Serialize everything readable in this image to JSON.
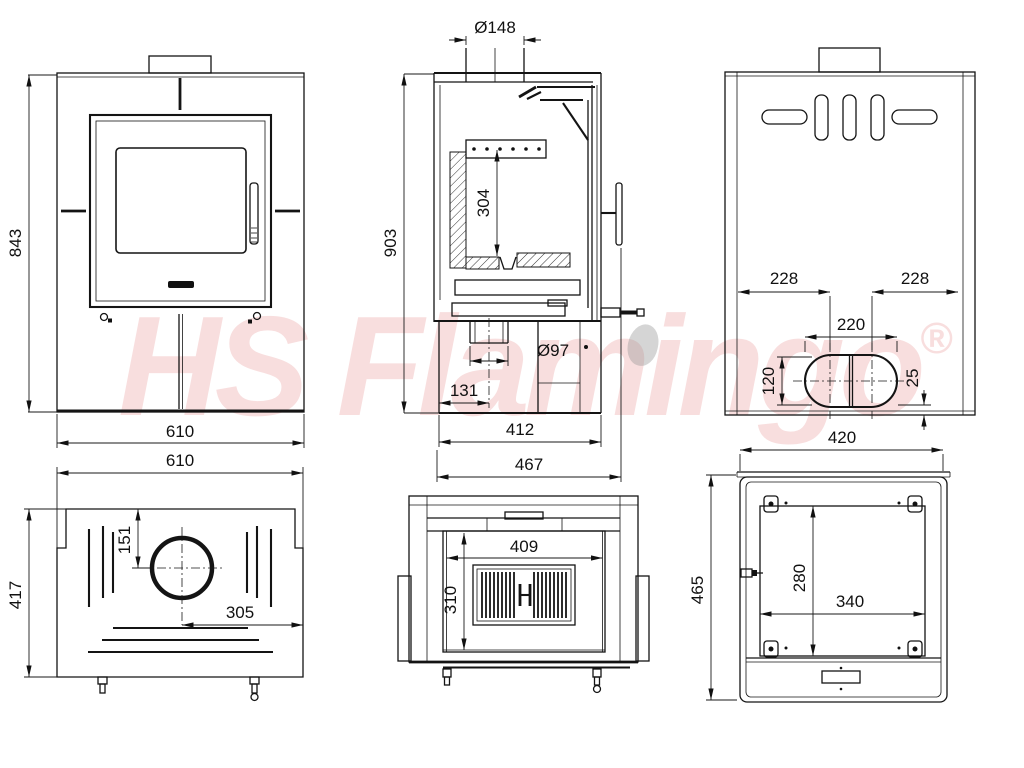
{
  "watermark": {
    "brand": "HS Flamingo",
    "registered_mark": "®"
  },
  "views": {
    "front": {
      "height": "843",
      "width": "610"
    },
    "section": {
      "flue_diameter": "Ø148",
      "total_height": "903",
      "firebox_height": "304",
      "outlet_diameter": "Ø97",
      "outlet_offset": "131",
      "body_depth": "412",
      "total_depth": "467"
    },
    "rear": {
      "offset_left": "228",
      "offset_right": "228",
      "outlet_width": "220",
      "outlet_height": "120",
      "bottom_offset": "25"
    },
    "top": {
      "width": "610",
      "depth": "417",
      "flue_offset_front": "151",
      "flue_offset_side": "305"
    },
    "firebox": {
      "opening_width": "409",
      "opening_height": "310"
    },
    "bottom": {
      "width": "420",
      "depth": "465",
      "base_width": "340",
      "base_depth": "280"
    }
  }
}
